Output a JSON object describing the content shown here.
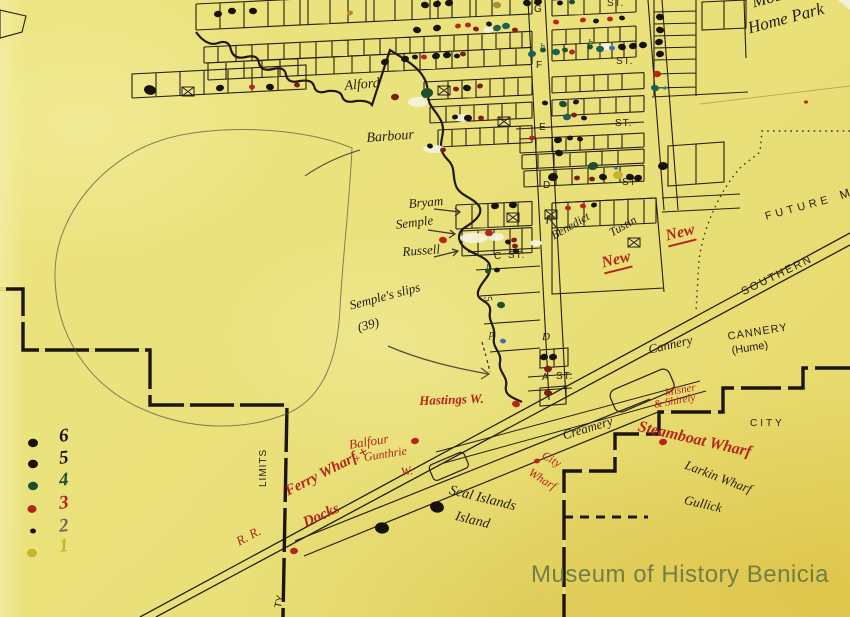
{
  "watermark": "Museum of History Benicia",
  "colors": {
    "paper": "#eade7b",
    "ink": "#231d12",
    "red": "#b5251a",
    "mrn": "#7e1d10",
    "tea": "#1d6054",
    "dgr": "#1c4f2c",
    "olv": "#ad8f2c",
    "yel": "#c9b32e",
    "blu": "#3f6fae",
    "gry": "#6e6a5c",
    "blk": "#17130c",
    "pencil": "#5f5b48",
    "watermark": "#6d7a44"
  },
  "legend": {
    "items": [
      {
        "num": "6",
        "num_color": "blk",
        "dot_color": "blk",
        "dot_r": 5,
        "dot_y": 443,
        "num_y": 427
      },
      {
        "num": "5",
        "num_color": "blk",
        "dot_color": "blk",
        "dot_r": 5,
        "dot_y": 464,
        "num_y": 449
      },
      {
        "num": "4",
        "num_color": "dgr",
        "dot_color": "dgr",
        "dot_r": 5,
        "dot_y": 486,
        "num_y": 471
      },
      {
        "num": "3",
        "num_color": "red",
        "dot_color": "red",
        "dot_r": 4.5,
        "dot_y": 509,
        "num_y": 494
      },
      {
        "num": "2",
        "num_color": "gry",
        "dot_color": "blk",
        "dot_r": 3,
        "dot_y": 531,
        "num_y": 517
      },
      {
        "num": "1",
        "num_color": "yel",
        "dot_color": "yel",
        "dot_r": 5,
        "dot_y": 553,
        "num_y": 537
      }
    ]
  },
  "street_labels": [
    {
      "t": "G",
      "x": 534,
      "y": 5
    },
    {
      "t": "ST.",
      "x": 607,
      "y": -1
    },
    {
      "t": "F",
      "x": 536,
      "y": 61
    },
    {
      "t": "ST.",
      "x": 616,
      "y": 57
    },
    {
      "t": "E",
      "x": 539,
      "y": 123
    },
    {
      "t": "ST.",
      "x": 615,
      "y": 119
    },
    {
      "t": "D",
      "x": 543,
      "y": 181
    },
    {
      "t": "ST",
      "x": 622,
      "y": 178
    },
    {
      "t": "C",
      "x": 494,
      "y": 252
    },
    {
      "t": "ST.",
      "x": 508,
      "y": 251
    },
    {
      "t": "A",
      "x": 542,
      "y": 373
    },
    {
      "t": "ST.",
      "x": 556,
      "y": 372
    }
  ],
  "labels": [
    {
      "id": "mobile-home-park-1",
      "t": "Mobile",
      "x": 750,
      "y": -6,
      "r": -15,
      "s": 17,
      "c": "ink",
      "f": "s"
    },
    {
      "id": "mobile-home-park-2",
      "t": "Home Park",
      "x": 746,
      "y": 20,
      "r": -15,
      "s": 17,
      "c": "ink",
      "f": "s"
    },
    {
      "id": "alford",
      "t": "Alford",
      "x": 344,
      "y": 80,
      "r": -5,
      "s": 14,
      "c": "ink",
      "f": "s"
    },
    {
      "id": "barbour",
      "t": "Barbour",
      "x": 366,
      "y": 132,
      "r": -4,
      "s": 14,
      "c": "ink",
      "f": "s"
    },
    {
      "id": "bryam",
      "t": "Bryam",
      "x": 408,
      "y": 197,
      "r": -5,
      "s": 13,
      "c": "ink",
      "f": "s"
    },
    {
      "id": "semple",
      "t": "Semple",
      "x": 395,
      "y": 218,
      "r": -7,
      "s": 13,
      "c": "ink",
      "f": "s"
    },
    {
      "id": "russell",
      "t": "Russell",
      "x": 402,
      "y": 245,
      "r": -4,
      "s": 13,
      "c": "ink",
      "f": "s"
    },
    {
      "id": "benedict",
      "t": "Benedict",
      "x": 549,
      "y": 231,
      "r": -30,
      "s": 12,
      "c": "ink",
      "f": "s"
    },
    {
      "id": "tustin",
      "t": "Tustin",
      "x": 607,
      "y": 228,
      "r": -30,
      "s": 12,
      "c": "ink",
      "f": "s"
    },
    {
      "id": "new-1",
      "t": "New",
      "x": 600,
      "y": 256,
      "r": -14,
      "s": 16,
      "c": "red",
      "f": "s",
      "w": 1,
      "u": 1
    },
    {
      "id": "new-2",
      "t": "New",
      "x": 664,
      "y": 229,
      "r": -14,
      "s": 16,
      "c": "red",
      "f": "s",
      "w": 1,
      "u": 1
    },
    {
      "id": "semples-slips",
      "t": "Semple's slips",
      "x": 348,
      "y": 299,
      "r": -15,
      "s": 13,
      "c": "ink",
      "f": "s"
    },
    {
      "id": "slips-39",
      "t": "(39)",
      "x": 356,
      "y": 321,
      "r": -15,
      "s": 13,
      "c": "ink",
      "f": "s"
    },
    {
      "id": "hastings-w",
      "t": "Hastings W.",
      "x": 419,
      "y": 394,
      "r": -2,
      "s": 13,
      "c": "red",
      "f": "s",
      "w": 1
    },
    {
      "id": "balfour-1",
      "t": "Balfour",
      "x": 348,
      "y": 438,
      "r": -9,
      "s": 13,
      "c": "red",
      "f": "s"
    },
    {
      "id": "balfour-2",
      "t": "+ Gunthrie",
      "x": 352,
      "y": 453,
      "r": -9,
      "s": 12,
      "c": "red",
      "f": "s"
    },
    {
      "id": "balfour-3",
      "t": "W.",
      "x": 400,
      "y": 466,
      "r": -9,
      "s": 12,
      "c": "red",
      "f": "s"
    },
    {
      "id": "ferry-wharf",
      "t": "Ferry Wharf +",
      "x": 283,
      "y": 486,
      "r": -27,
      "s": 15,
      "c": "red",
      "f": "s",
      "w": 1
    },
    {
      "id": "docks",
      "t": "Docks",
      "x": 301,
      "y": 517,
      "r": -24,
      "s": 15,
      "c": "red",
      "f": "s",
      "w": 1
    },
    {
      "id": "rr",
      "t": "R. R.",
      "x": 234,
      "y": 536,
      "r": -28,
      "s": 13,
      "c": "red",
      "f": "s"
    },
    {
      "id": "seal-islands-1",
      "t": "Seal Islands",
      "x": 451,
      "y": 484,
      "r": 14,
      "s": 14,
      "c": "ink",
      "f": "s"
    },
    {
      "id": "seal-islands-2",
      "t": "Island",
      "x": 457,
      "y": 510,
      "r": 14,
      "s": 14,
      "c": "ink",
      "f": "s"
    },
    {
      "id": "city-wharf-1",
      "t": "City",
      "x": 546,
      "y": 449,
      "r": 30,
      "s": 12,
      "c": "red",
      "f": "s"
    },
    {
      "id": "city-wharf-2",
      "t": "Wharf",
      "x": 533,
      "y": 466,
      "r": 32,
      "s": 12,
      "c": "red",
      "f": "s"
    },
    {
      "id": "creamery",
      "t": "Creamery",
      "x": 561,
      "y": 429,
      "r": -17,
      "s": 13,
      "c": "ink",
      "f": "s"
    },
    {
      "id": "cannery-script",
      "t": "Cannery",
      "x": 647,
      "y": 343,
      "r": -13,
      "s": 13,
      "c": "ink",
      "f": "s"
    },
    {
      "id": "cannery-print",
      "t": "CANNERY",
      "x": 727,
      "y": 332,
      "r": -9,
      "s": 11,
      "c": "ink",
      "f": "p",
      "ls": 1
    },
    {
      "id": "cannery-hume",
      "t": "(Hume)",
      "x": 731,
      "y": 346,
      "r": -9,
      "s": 11,
      "c": "ink",
      "f": "p"
    },
    {
      "id": "misner-1",
      "t": "Misner",
      "x": 664,
      "y": 388,
      "r": -10,
      "s": 11,
      "c": "red",
      "f": "s"
    },
    {
      "id": "misner-2",
      "t": "& Shirely",
      "x": 653,
      "y": 400,
      "r": -10,
      "s": 11,
      "c": "red",
      "f": "s"
    },
    {
      "id": "steamboat-wharf",
      "t": "Steamboat Wharf",
      "x": 640,
      "y": 419,
      "r": 13,
      "s": 16,
      "c": "red",
      "f": "s",
      "w": 1
    },
    {
      "id": "larkin-wharf",
      "t": "Larkin Wharf",
      "x": 688,
      "y": 458,
      "r": 21,
      "s": 13,
      "c": "ink",
      "f": "s"
    },
    {
      "id": "gullick",
      "t": "Gullick",
      "x": 686,
      "y": 493,
      "r": 13,
      "s": 13,
      "c": "ink",
      "f": "s"
    },
    {
      "id": "city",
      "t": "CITY",
      "x": 750,
      "y": 419,
      "r": 0,
      "s": 10,
      "c": "ink",
      "f": "p",
      "ls": 3
    },
    {
      "id": "southern",
      "t": "SOUTHERN",
      "x": 740,
      "y": 288,
      "r": -26,
      "s": 11,
      "c": "ink",
      "f": "p",
      "ls": 2
    },
    {
      "id": "future",
      "t": "FUTURE",
      "x": 764,
      "y": 212,
      "r": -15,
      "s": 11,
      "c": "ink",
      "f": "p",
      "ls": 4
    },
    {
      "id": "future-m",
      "t": "M",
      "x": 838,
      "y": 190,
      "r": -20,
      "s": 12,
      "c": "ink",
      "f": "p"
    },
    {
      "id": "city-limits",
      "t": "LIMITS",
      "x": 259,
      "y": 487,
      "r": -90,
      "s": 10,
      "c": "ink",
      "f": "p",
      "ls": 1
    },
    {
      "id": "city-ty",
      "t": "TY",
      "x": 274,
      "y": 607,
      "r": -78,
      "s": 10,
      "c": "ink",
      "f": "p"
    }
  ],
  "marks": [
    {
      "t": "b",
      "x": 540,
      "y": 43,
      "c": "tea",
      "s": 10,
      "r": 0
    },
    {
      "t": "b",
      "x": 588,
      "y": 39,
      "c": "dgr",
      "s": 10,
      "r": 0
    },
    {
      "t": "b",
      "x": 486,
      "y": 264,
      "c": "dgr",
      "s": 10,
      "r": 0
    },
    {
      "t": "5",
      "x": 492,
      "y": 295,
      "c": "ink",
      "s": 11,
      "r": 75
    },
    {
      "t": "p",
      "x": 489,
      "y": 330,
      "c": "ink",
      "s": 10,
      "r": 0
    },
    {
      "t": "D",
      "x": 542,
      "y": 332,
      "c": "ink",
      "s": 11,
      "r": 0
    }
  ],
  "dots": [
    [
      350,
      13,
      3,
      "olv"
    ],
    [
      218,
      14,
      4,
      "blk"
    ],
    [
      232,
      11,
      4,
      "blk"
    ],
    [
      253,
      11,
      4,
      "blk"
    ],
    [
      425,
      5,
      4,
      "blk"
    ],
    [
      437,
      4,
      4,
      "blk"
    ],
    [
      449,
      3,
      4,
      "blk"
    ],
    [
      497,
      5,
      4,
      "olv"
    ],
    [
      527,
      3,
      4,
      "blk"
    ],
    [
      538,
      2,
      4,
      "blk"
    ],
    [
      560,
      3,
      3,
      "blk"
    ],
    [
      572,
      2,
      3,
      "dgr"
    ],
    [
      417,
      30,
      4,
      "blk"
    ],
    [
      437,
      28,
      4,
      "blk"
    ],
    [
      458,
      26,
      3,
      "red"
    ],
    [
      468,
      25,
      3,
      "red"
    ],
    [
      476,
      29,
      3,
      "mrn"
    ],
    [
      489,
      24,
      3,
      "blk"
    ],
    [
      497,
      28,
      4,
      "tea"
    ],
    [
      506,
      26,
      4,
      "tea"
    ],
    [
      515,
      30,
      3,
      "mrn"
    ],
    [
      556,
      22,
      3,
      "red"
    ],
    [
      583,
      20,
      3,
      "red"
    ],
    [
      596,
      21,
      3,
      "blk"
    ],
    [
      610,
      19,
      3,
      "red"
    ],
    [
      622,
      18,
      3,
      "blk"
    ],
    [
      385,
      62,
      4,
      "blk"
    ],
    [
      405,
      59,
      4,
      "blk"
    ],
    [
      415,
      57,
      3,
      "blk"
    ],
    [
      424,
      57,
      3,
      "red"
    ],
    [
      436,
      56,
      4,
      "blk"
    ],
    [
      447,
      55,
      4,
      "blk"
    ],
    [
      457,
      56,
      3,
      "blk"
    ],
    [
      463,
      54,
      3,
      "mrn"
    ],
    [
      150,
      90,
      6,
      "blk"
    ],
    [
      220,
      88,
      4,
      "blk"
    ],
    [
      252,
      87,
      3,
      "red"
    ],
    [
      270,
      87,
      4,
      "blk"
    ],
    [
      297,
      85,
      3,
      "mrn"
    ],
    [
      532,
      54,
      4,
      "tea"
    ],
    [
      543,
      50,
      3,
      "dgr"
    ],
    [
      556,
      52,
      4,
      "tea"
    ],
    [
      565,
      50,
      3,
      "dgr"
    ],
    [
      572,
      52,
      3,
      "red"
    ],
    [
      590,
      47,
      3,
      "dgr"
    ],
    [
      600,
      49,
      4,
      "tea"
    ],
    [
      612,
      48,
      3,
      "blu"
    ],
    [
      622,
      47,
      4,
      "blk"
    ],
    [
      633,
      46,
      4,
      "blk"
    ],
    [
      643,
      45,
      4,
      "blk"
    ],
    [
      660,
      17,
      4,
      "blk"
    ],
    [
      660,
      30,
      4,
      "blk"
    ],
    [
      659,
      42,
      4,
      "blk"
    ],
    [
      660,
      54,
      4,
      "blk"
    ],
    [
      657,
      74,
      4,
      "red"
    ],
    [
      655,
      88,
      4,
      "tea"
    ],
    [
      665,
      88,
      2,
      "blu"
    ],
    [
      427,
      93,
      6,
      "dgr"
    ],
    [
      456,
      89,
      3,
      "mrn"
    ],
    [
      467,
      88,
      4,
      "blk"
    ],
    [
      480,
      86,
      3,
      "mrn"
    ],
    [
      455,
      117,
      3,
      "blk"
    ],
    [
      468,
      118,
      4,
      "blk"
    ],
    [
      481,
      118,
      3,
      "mrn"
    ],
    [
      430,
      146,
      3,
      "blk"
    ],
    [
      443,
      150,
      3,
      "mrn"
    ],
    [
      395,
      97,
      4,
      "mrn"
    ],
    [
      545,
      103,
      3,
      "blk"
    ],
    [
      563,
      104,
      4,
      "dgr"
    ],
    [
      576,
      102,
      3,
      "blk"
    ],
    [
      567,
      117,
      4,
      "tea"
    ],
    [
      574,
      115,
      3,
      "mrn"
    ],
    [
      584,
      118,
      3,
      "blk"
    ],
    [
      532,
      138,
      3,
      "red"
    ],
    [
      558,
      140,
      4,
      "blk"
    ],
    [
      570,
      138,
      3,
      "blk"
    ],
    [
      580,
      139,
      3,
      "blk"
    ],
    [
      559,
      153,
      4,
      "blk"
    ],
    [
      553,
      177,
      5,
      "blk"
    ],
    [
      577,
      178,
      3,
      "mrn"
    ],
    [
      592,
      179,
      3,
      "mrn"
    ],
    [
      603,
      177,
      4,
      "blk"
    ],
    [
      593,
      166,
      5,
      "dgr"
    ],
    [
      618,
      175,
      5,
      "yel"
    ],
    [
      616,
      168,
      2,
      "blu"
    ],
    [
      630,
      177,
      4,
      "blk"
    ],
    [
      638,
      178,
      4,
      "blk"
    ],
    [
      663,
      166,
      5,
      "blk"
    ],
    [
      568,
      208,
      3,
      "red"
    ],
    [
      583,
      206,
      3,
      "red"
    ],
    [
      594,
      205,
      3,
      "blk"
    ],
    [
      495,
      206,
      4,
      "blk"
    ],
    [
      513,
      205,
      4,
      "blk"
    ],
    [
      489,
      233,
      4,
      "red"
    ],
    [
      508,
      242,
      3,
      "blk"
    ],
    [
      514,
      240,
      3,
      "mrn"
    ],
    [
      515,
      246,
      3,
      "mrn"
    ],
    [
      516,
      251,
      3,
      "blk"
    ],
    [
      443,
      240,
      4,
      "red"
    ],
    [
      488,
      271,
      3,
      "dgr"
    ],
    [
      497,
      270,
      3,
      "blk"
    ],
    [
      501,
      305,
      4,
      "dgr"
    ],
    [
      503,
      341,
      3,
      "blu"
    ],
    [
      544,
      357,
      4,
      "blk"
    ],
    [
      553,
      357,
      4,
      "blk"
    ],
    [
      548,
      369,
      4,
      "mrn"
    ],
    [
      548,
      393,
      4,
      "mrn"
    ],
    [
      516,
      404,
      4,
      "red"
    ],
    [
      415,
      441,
      4,
      "red"
    ],
    [
      294,
      551,
      4,
      "red"
    ],
    [
      382,
      528,
      7,
      "blk"
    ],
    [
      437,
      507,
      7,
      "blk"
    ],
    [
      537,
      461,
      3,
      "red"
    ],
    [
      663,
      442,
      4,
      "red"
    ],
    [
      806,
      102,
      2,
      "red"
    ]
  ],
  "boxes": [
    [
      438,
      86
    ],
    [
      498,
      117
    ],
    [
      182,
      87
    ],
    [
      507,
      213
    ],
    [
      545,
      210
    ],
    [
      628,
      238
    ]
  ]
}
